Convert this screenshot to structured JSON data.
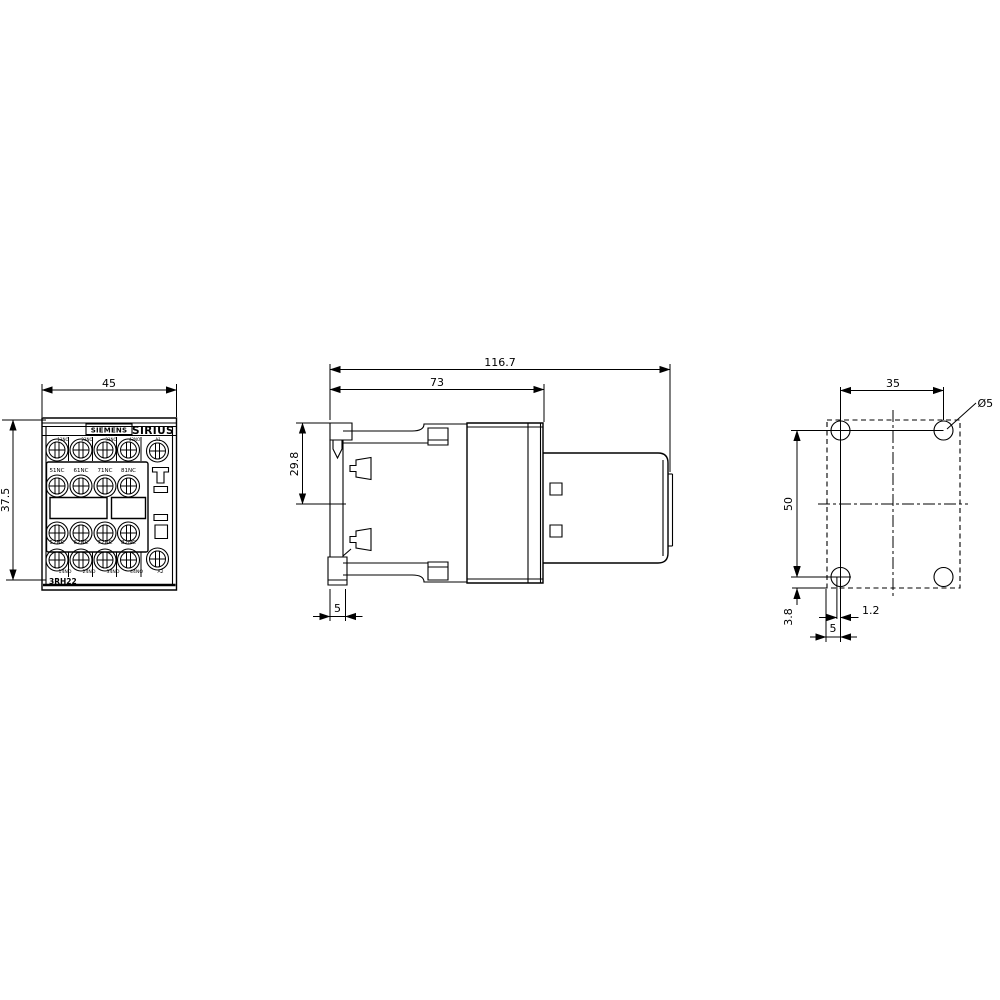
{
  "drawing": {
    "colors": {
      "line": "#000000",
      "background": "#ffffff"
    },
    "front_view": {
      "dim_width": "45",
      "dim_height": "37.5",
      "brand": "SIEMENS",
      "series": "SIRIUS",
      "model": "3RH22",
      "terminals": {
        "top_row": [
          "13NO",
          "23NO",
          "33NO",
          "43NO",
          "A1"
        ],
        "nc_upper": [
          "51NC",
          "61NC",
          "71NC",
          "81NC"
        ],
        "nc_lower": [
          "52NC",
          "62NC",
          "72NC",
          "82NC"
        ],
        "bottom_row": [
          "14NO",
          "24NO",
          "34NO",
          "44NO",
          "A2"
        ]
      }
    },
    "side_view": {
      "dim_total_depth": "116.7",
      "dim_front_depth": "73",
      "dim_upper": "29.8",
      "dim_rail": "5"
    },
    "drill_plan": {
      "dim_hole_spacing_h": "35",
      "dim_hole_spacing_v": "50",
      "dim_bottom_offset": "3.8",
      "dim_hole_offset": "1.2",
      "dim_edge_offset": "5",
      "hole_diameter": "Ø5"
    }
  }
}
